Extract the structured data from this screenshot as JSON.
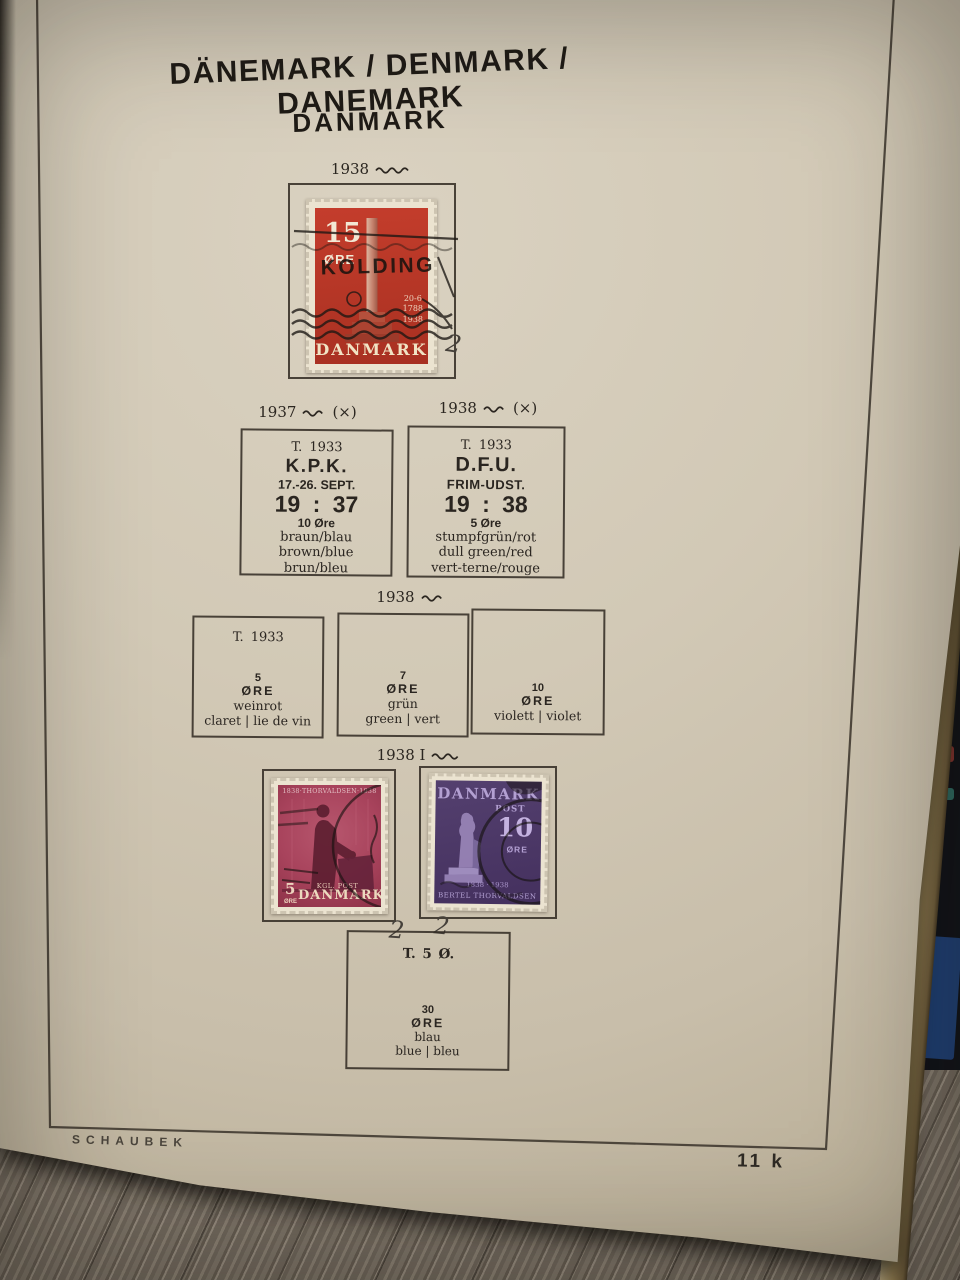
{
  "page": {
    "header": {
      "title_trilingual": "DÄNEMARK / DENMARK / DANEMARK",
      "title_native": "DANMARK"
    },
    "s1": {
      "year": "1938",
      "stamp": {
        "denomination": "15",
        "currency": "ØRE",
        "country": "DANMARK",
        "postmark_town": "KOLDING",
        "dates": [
          "20-6",
          "1788",
          "1938"
        ],
        "pencil_note": "2"
      }
    },
    "events": {
      "left_year": "1937",
      "left_mark": "(×)",
      "right_year": "1938",
      "right_mark": "(×)",
      "kpk": {
        "type": "T. 1933",
        "title": "K.P.K.",
        "dates": "17.-26. SEPT.",
        "year": "19 : 37",
        "denomination": "10 Øre",
        "color_de": "braun/blau",
        "color_en": "brown/blue",
        "color_fr": "brun/bleu"
      },
      "dfu": {
        "type": "T. 1933",
        "title": "D.F.U.",
        "subtitle": "FRIM-UDST.",
        "year": "19 : 38",
        "denomination": "5 Øre",
        "color_de": "stumpfgrün/rot",
        "color_en": "dull green/red",
        "color_fr": "vert-terne/rouge"
      }
    },
    "set1938": {
      "year": "1938",
      "b5": {
        "type": "T. 1933",
        "denomination": "5",
        "currency": "ØRE",
        "color_de": "weinrot",
        "color_intl": "claret | lie de vin"
      },
      "b7": {
        "denomination": "7",
        "currency": "ØRE",
        "color_de": "grün",
        "color_intl": "green | vert"
      },
      "b10": {
        "denomination": "10",
        "currency": "ØRE",
        "color_intl": "violett | violet"
      }
    },
    "thor": {
      "year": "1938 I",
      "s5": {
        "top_inscription": "1838·THORVALDSEN·1938",
        "denomination": "5",
        "currency": "ØRE",
        "service": "KGL. POST",
        "country": "DANMARK",
        "pencil_note": "2"
      },
      "s10": {
        "country": "DANMARK",
        "service": "POST",
        "denomination": "10",
        "currency": "ØRE",
        "years": "1838 · 1938",
        "inscription": "BERTEL THORVALDSEN",
        "pencil_note": "2"
      },
      "b30": {
        "type": "T. 5 Ø.",
        "denomination": "30",
        "currency": "ØRE",
        "color_de": "blau",
        "color_intl": "blue | bleu"
      }
    },
    "footer": {
      "publisher": "SCHAUBEK",
      "page_number": "11 k"
    },
    "colors": {
      "stamp_red": "#bf392a",
      "stamp_carmine": "#a23d55",
      "stamp_violet": "#4b3566",
      "paper": "#cfc6b3",
      "postmark_ink": "#1c1814"
    }
  }
}
